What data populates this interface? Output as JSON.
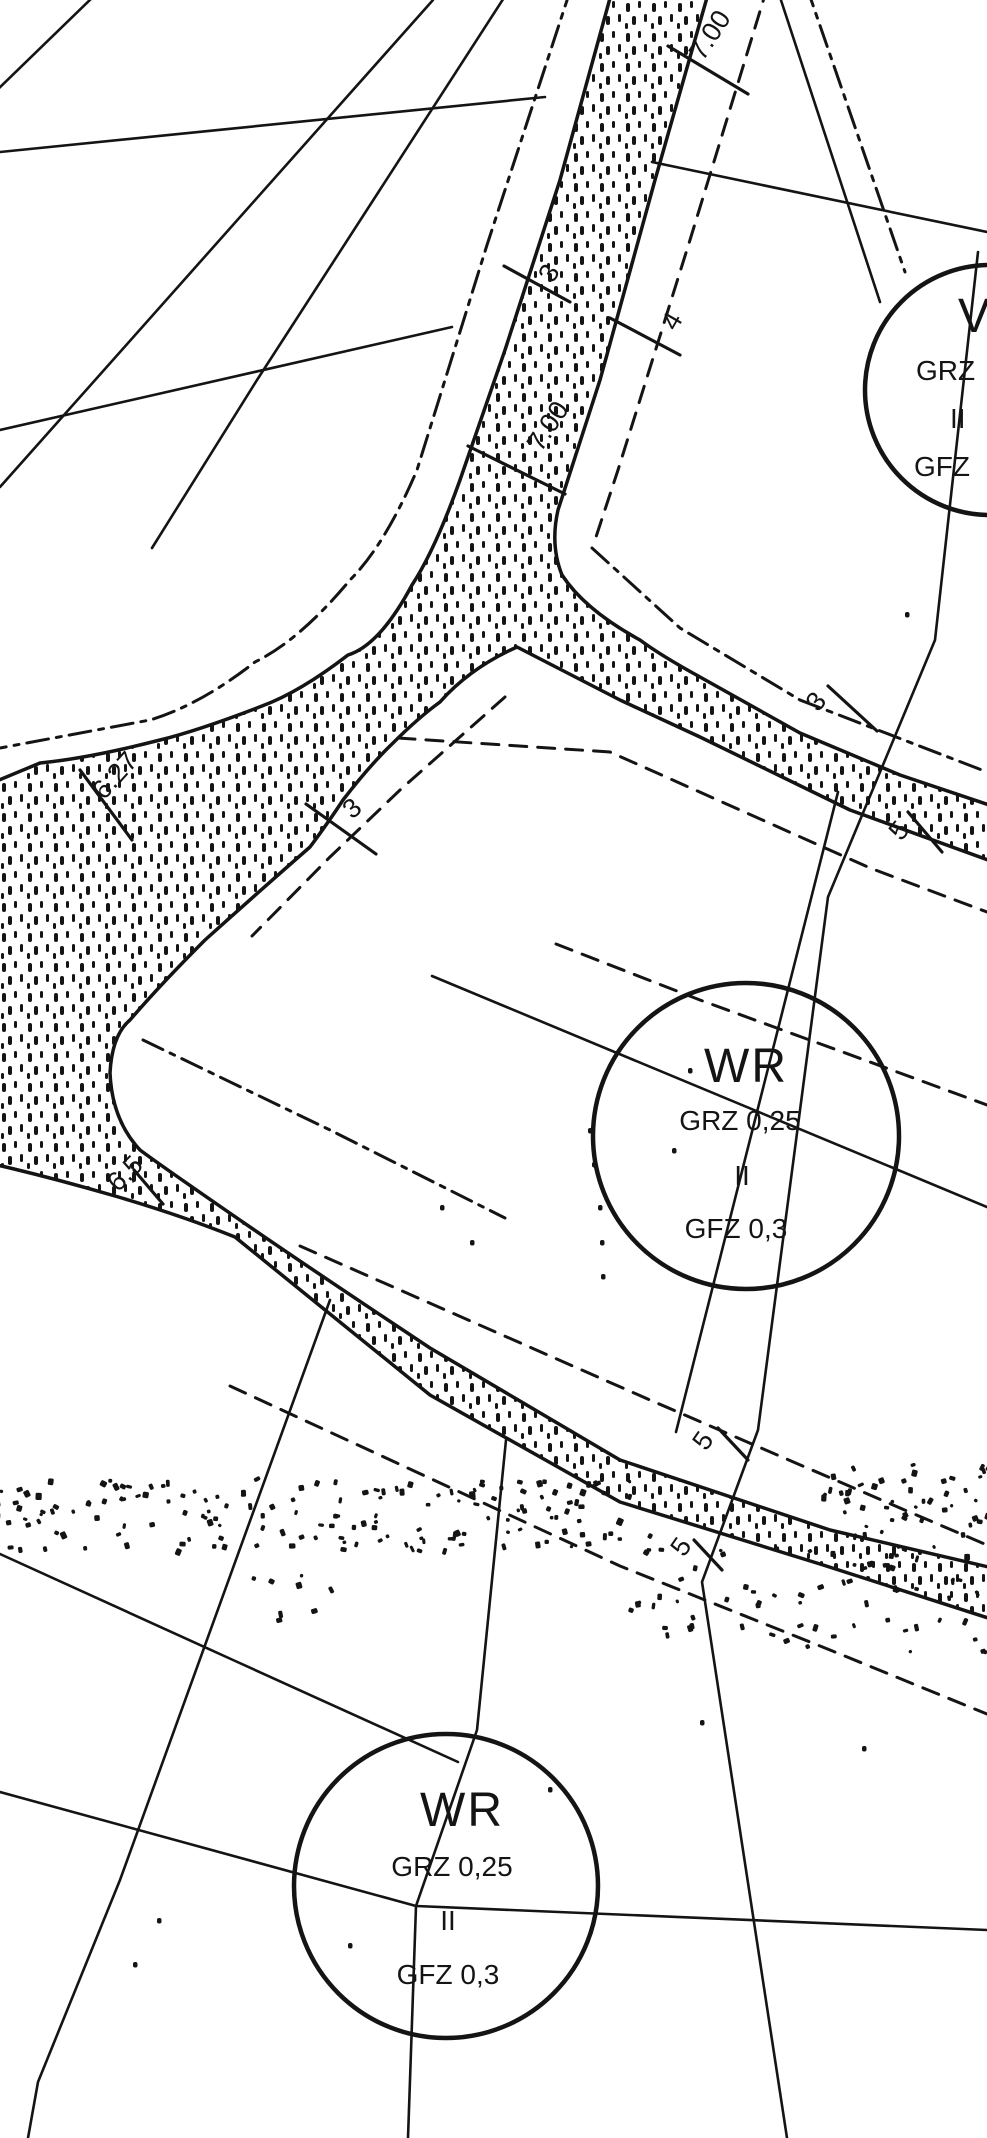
{
  "document": {
    "kind": "zoning-plan-scan",
    "paper_color": "#ffffff",
    "ink_color": "#141414"
  },
  "zones": [
    {
      "id": "zone-top-right",
      "clipped_at_edge": true,
      "cx": 990,
      "cy": 390,
      "r": 125,
      "lines": [
        {
          "text": "V",
          "x": 958,
          "y": 332,
          "cls": "zone-main"
        },
        {
          "text": "GRZ",
          "x": 916,
          "y": 380,
          "cls": "zone-sub"
        },
        {
          "text": "II",
          "x": 950,
          "y": 428,
          "cls": "zone-sub"
        },
        {
          "text": "GFZ",
          "x": 914,
          "y": 476,
          "cls": "zone-sub"
        }
      ]
    },
    {
      "id": "zone-middle",
      "clipped_at_edge": false,
      "cx": 746,
      "cy": 1136,
      "r": 153,
      "lines": [
        {
          "text": "WR",
          "x": 746,
          "y": 1082,
          "cls": "zone-main",
          "anchor": "middle"
        },
        {
          "text": "GRZ 0,25",
          "x": 740,
          "y": 1130,
          "cls": "zone-sub",
          "anchor": "middle"
        },
        {
          "text": "II",
          "x": 742,
          "y": 1185,
          "cls": "zone-sub",
          "anchor": "middle"
        },
        {
          "text": "GFZ 0,3",
          "x": 736,
          "y": 1238,
          "cls": "zone-sub",
          "anchor": "middle"
        }
      ]
    },
    {
      "id": "zone-bottom",
      "clipped_at_edge": false,
      "cx": 446,
      "cy": 1886,
      "r": 152,
      "lines": [
        {
          "text": "WR",
          "x": 462,
          "y": 1826,
          "cls": "zone-main",
          "anchor": "middle"
        },
        {
          "text": "GRZ 0,25",
          "x": 452,
          "y": 1876,
          "cls": "zone-sub",
          "anchor": "middle"
        },
        {
          "text": "II",
          "x": 448,
          "y": 1930,
          "cls": "zone-sub",
          "anchor": "middle"
        },
        {
          "text": "GFZ 0,3",
          "x": 448,
          "y": 1984,
          "cls": "zone-sub",
          "anchor": "middle"
        }
      ]
    }
  ],
  "dimensions": [
    {
      "label": "7.00",
      "x": 703,
      "y": 62,
      "rot": -57,
      "tick": [
        668,
        46,
        748,
        94
      ]
    },
    {
      "label": "3",
      "x": 553,
      "y": 284,
      "rot": -60,
      "tick": [
        504,
        266,
        570,
        302
      ]
    },
    {
      "label": "4",
      "x": 676,
      "y": 332,
      "rot": -60,
      "tick": [
        610,
        318,
        680,
        355
      ]
    },
    {
      "label": "7.00",
      "x": 541,
      "y": 453,
      "rot": -57,
      "tick": [
        468,
        446,
        565,
        494
      ]
    },
    {
      "label": "3",
      "x": 352,
      "y": 820,
      "rot": -40,
      "tick": [
        306,
        804,
        376,
        854
      ]
    },
    {
      "label": "6.27",
      "x": 104,
      "y": 801,
      "rot": -48,
      "tick": [
        80,
        770,
        132,
        840
      ]
    },
    {
      "label": "3",
      "x": 818,
      "y": 713,
      "rot": -50,
      "tick": [
        828,
        686,
        877,
        731
      ]
    },
    {
      "label": "5",
      "x": 901,
      "y": 842,
      "rot": -50,
      "tick": [
        908,
        812,
        942,
        852
      ]
    },
    {
      "label": "5",
      "x": 706,
      "y": 1452,
      "rot": -55,
      "tick": [
        718,
        1428,
        748,
        1460
      ]
    },
    {
      "label": "5",
      "x": 684,
      "y": 1558,
      "rot": -55,
      "tick": [
        694,
        1540,
        722,
        1570
      ]
    },
    {
      "label": "6,5",
      "x": 118,
      "y": 1193,
      "rot": -45,
      "tick": [
        134,
        1170,
        163,
        1204
      ]
    }
  ],
  "dust_regions": [
    {
      "x0": -10,
      "y0": 1478,
      "x1": 650,
      "y1": 1548,
      "n": 170
    },
    {
      "x0": 620,
      "y0": 1545,
      "x1": 990,
      "y1": 1650,
      "n": 70
    },
    {
      "x0": 820,
      "y0": 1462,
      "x1": 990,
      "y1": 1535,
      "n": 50
    },
    {
      "x0": 250,
      "y0": 1560,
      "x1": 330,
      "y1": 1620,
      "n": 8
    }
  ],
  "stray_dots": [
    [
      588,
      1128
    ],
    [
      592,
      1162
    ],
    [
      598,
      1205
    ],
    [
      600,
      1240
    ],
    [
      601,
      1274
    ],
    [
      688,
      1068
    ],
    [
      672,
      1148
    ],
    [
      348,
      1943
    ],
    [
      157,
      1918
    ],
    [
      133,
      1962
    ],
    [
      548,
      1787
    ],
    [
      700,
      1720
    ],
    [
      862,
      1746
    ],
    [
      905,
      612
    ],
    [
      440,
      1205
    ],
    [
      470,
      1240
    ]
  ]
}
